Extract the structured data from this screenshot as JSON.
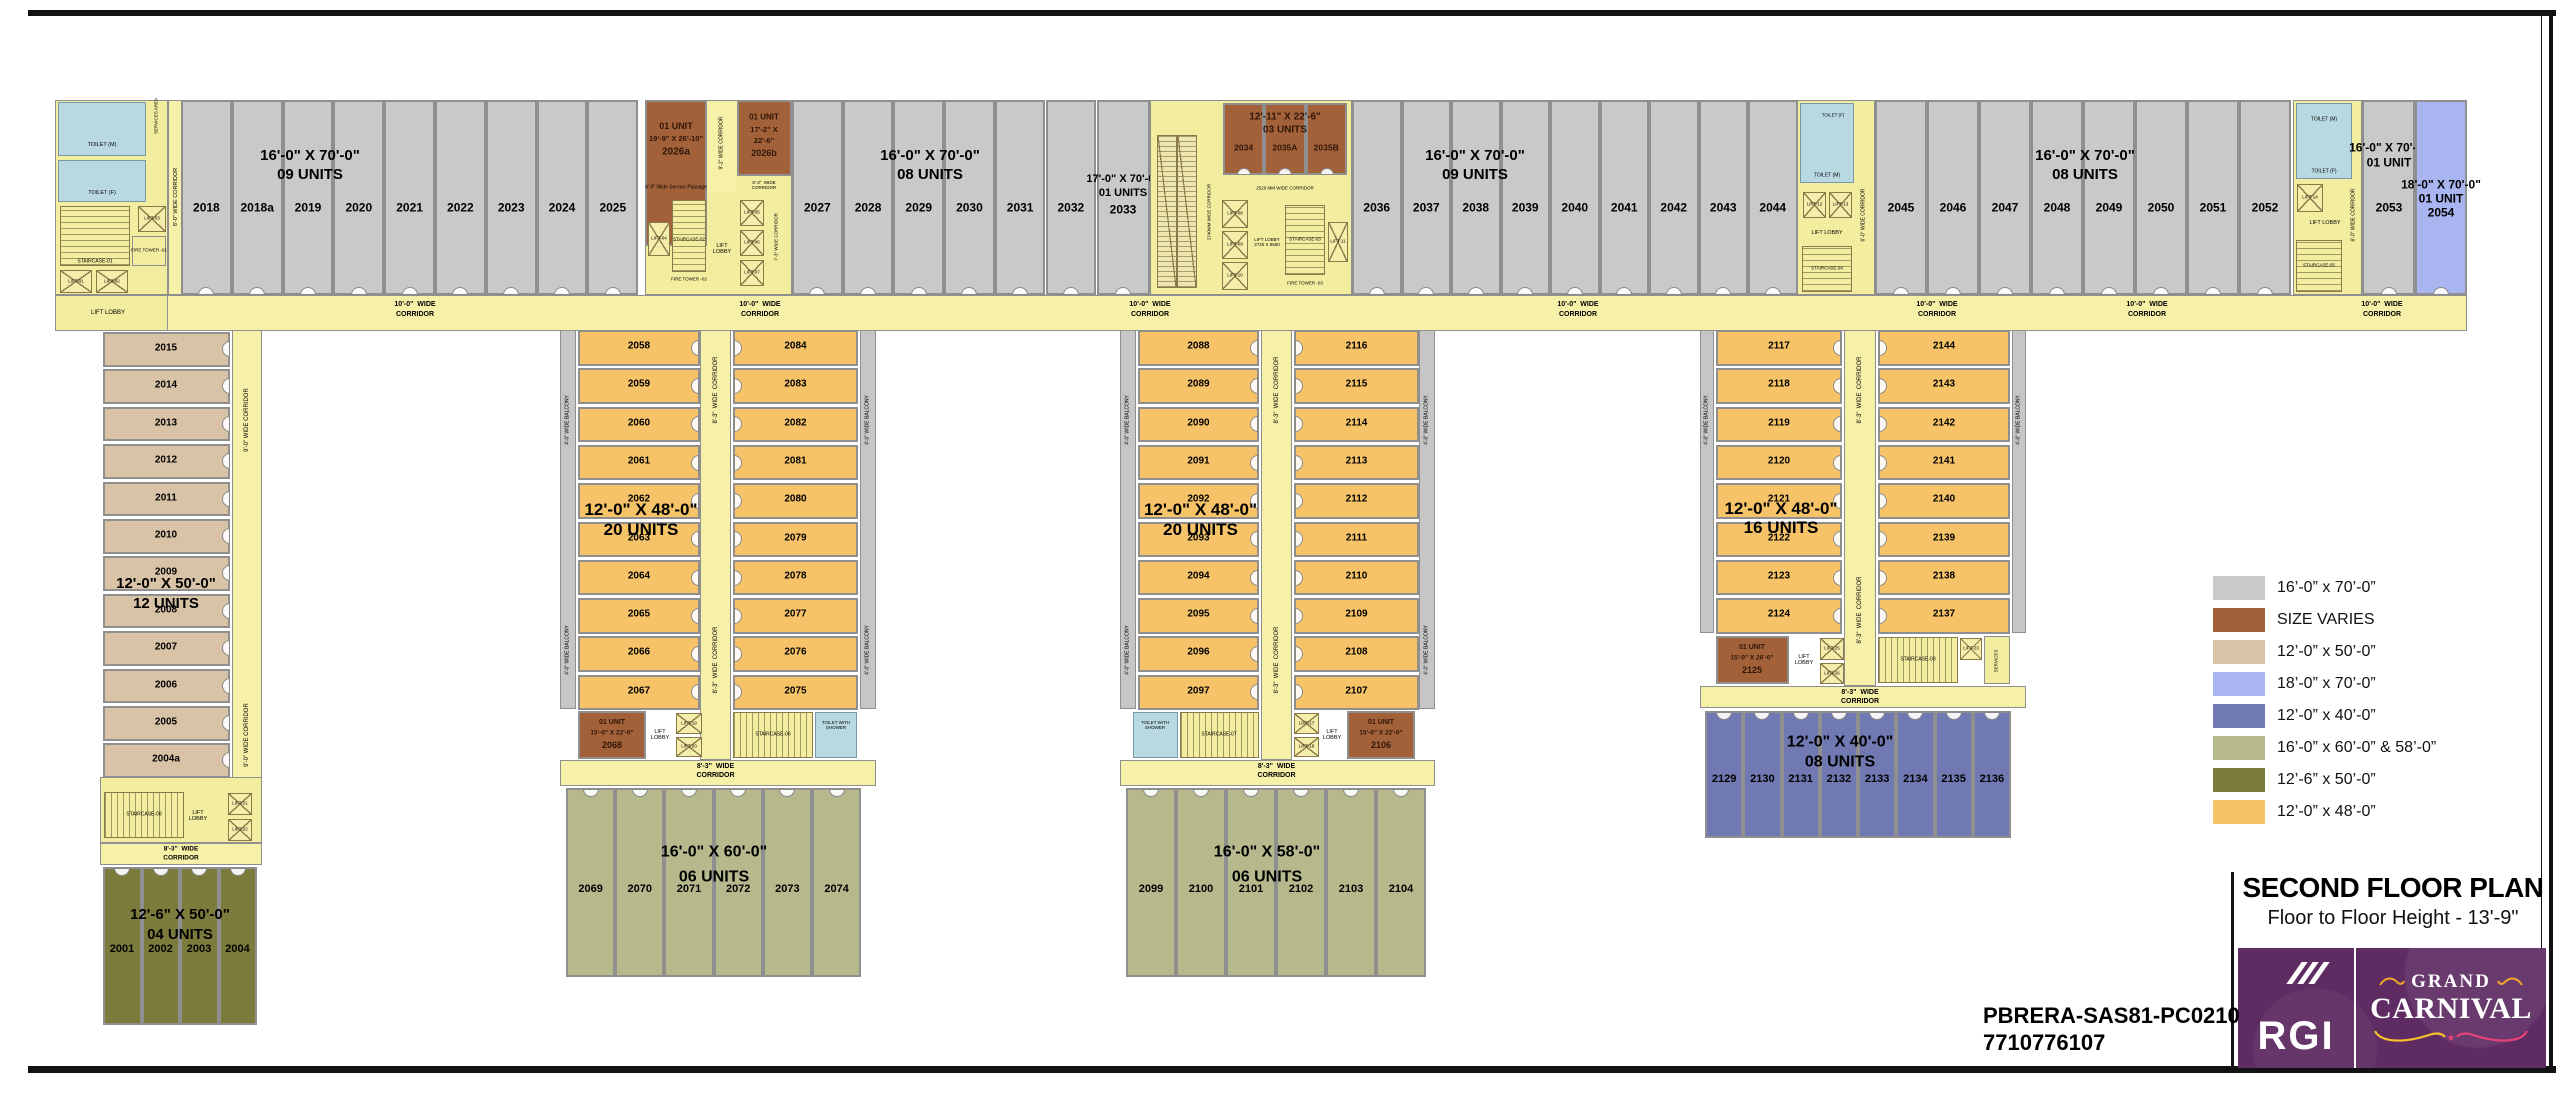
{
  "title_block": {
    "title": "SECOND FLOOR PLAN",
    "subtitle": "Floor to Floor Height - 13'-9\"",
    "rera_line1": "PBRERA-SAS81-PC0210",
    "rera_line2": "7710776107",
    "logo_brand": "RGI",
    "logo_project_line1": "GRAND",
    "logo_project_line2": "CARNIVAL"
  },
  "legend": {
    "items": [
      {
        "color": "#c9c9c9",
        "label": "16’-0” x 70’-0”"
      },
      {
        "color": "#a3613a",
        "label": "SIZE VARIES"
      },
      {
        "color": "#d9c3a7",
        "label": "12’-0” x 50’-0”"
      },
      {
        "color": "#a9b5f0",
        "label": "18’-0” x 70’-0”"
      },
      {
        "color": "#7079b2",
        "label": "12’-0” x 40’-0”"
      },
      {
        "color": "#b5b98c",
        "label": "16’-0” x 60’-0” & 58’-0”"
      },
      {
        "color": "#7b7b3b",
        "label": "12’-6” x 50’-0”"
      },
      {
        "color": "#f6c368",
        "label": "12’-0” x 48’-0”"
      }
    ]
  },
  "corridors": {
    "main_l1": "10'-0\"  WIDE",
    "main_l2": "CORRIDOR",
    "w83": "8'-3\"  WIDE  CORRIDOR",
    "w83_l1": "8'-3\"  WIDE",
    "w83_l2": "CORRIDOR",
    "w90": "9'-0\" WIDE CORRIDOR",
    "w80": "8'-0\" WIDE CORRIDOR",
    "w92": "9'-2\" WIDE CORRIDOR",
    "w73": "7'-3\" WIDE CORRIDOR",
    "w60": "6'-0\" WIDE CORRIDOR",
    "balcony": "4'-0\" WIDE BALCONY",
    "service_passage": "4'-0\" Wide Service Passage",
    "mm2520": "2520 MM WIDE CORRIDOR",
    "mm2740": "2740MM WIDE CORRIDOR"
  },
  "top_strip": {
    "g1": {
      "units": [
        "2018",
        "2018a",
        "2019",
        "2020",
        "2021",
        "2022",
        "2023",
        "2024",
        "2025"
      ],
      "l1": "16'-0\" X 70'-0\"",
      "l2": "09 UNITS"
    },
    "u2026a": {
      "l1": "01 UNIT",
      "l2": "19'-9\" X 26'-10\"",
      "num": "2026a"
    },
    "u2026b": {
      "l1": "01 UNIT",
      "l2": "17'-2\" X",
      "l3": "22'-6\"",
      "num": "2026b"
    },
    "g2": {
      "units": [
        "2027",
        "2028",
        "2029",
        "2030",
        "2031",
        "2032"
      ],
      "l1": "16'-0\" X 70'-0\"",
      "l2": "08 UNITS"
    },
    "u2033": {
      "l1": "17'-0\" X 70'-0\"",
      "l2": "01 UNITS",
      "num": "2033"
    },
    "triplet": {
      "l1": "12'-11\" X 22'-6\"",
      "l2": "03 UNITS",
      "units": [
        "2034",
        "2035A",
        "2035B"
      ]
    },
    "g3": {
      "units": [
        "2036",
        "2037",
        "2038",
        "2039",
        "2040",
        "2041",
        "2042",
        "2043",
        "2044"
      ],
      "l1": "16'-0\" X 70'-0\"",
      "l2": "09 UNITS"
    },
    "g4": {
      "units": [
        "2045",
        "2046",
        "2047",
        "2048",
        "2049",
        "2050",
        "2051",
        "2052"
      ],
      "l1": "16'-0\" X 70'-0\"",
      "l2": "08 UNITS"
    },
    "u2053": {
      "l1": "16'-0\" X 70'-0\"",
      "l2": "01 UNIT",
      "num": "2053"
    },
    "u2054": {
      "l1": "18'-0\" X 70'-0\"",
      "l2": "01 UNIT",
      "num": "2054"
    }
  },
  "cores": {
    "toilet_m": "TOILET (M)",
    "toilet_f": "TOILET (F)",
    "services_area": "SERVICES AREA",
    "services": "SERVICES",
    "lift_lobby": "LIFT LOBBY",
    "lift_lobby_l1": "LIFT",
    "lift_lobby_l2": "LOBBY",
    "lobby_dims": "2740 X 8550",
    "staircase_01": "STAIRCASE-01",
    "fire_tower_01": "FIRE TOWER -01",
    "staircase_02": "STAIRCASE-02",
    "fire_tower_02": "FIRE TOWER -02",
    "staircase_03": "STAIRCASE-03",
    "fire_tower_03": "FIRE TOWER -03",
    "staircase_04": "STAIRCASE-04",
    "staircase_05": "STAIRCASE-05",
    "lift_01": "LIFT-01",
    "lift_02": "LIFT-02",
    "lift_03": "LIFT-03",
    "lift_04": "LIFT-04",
    "lift_05": "LIFT-05",
    "lift_06": "LIFT-06",
    "lift_07": "LIFT-07",
    "lift_08": "LIFT-08",
    "lift_09": "LIFT-09",
    "lift_10": "LIFT-10",
    "lift_11": "LIFT-11",
    "lift_12": "LIFT-12",
    "lift_13": "LIFT-13",
    "lift_14": "LIFT-14"
  },
  "left_wing": {
    "units": [
      "2015",
      "2014",
      "2013",
      "2012",
      "2011",
      "2010",
      "2009",
      "2008",
      "2007",
      "2006",
      "2005",
      "2004a"
    ],
    "label_l1": "12'-0\" X 50'-0\"",
    "label_l2": "12 UNITS",
    "staircase": "STAIRCASE-08",
    "lifts": [
      "LIFT-21",
      "LIFT-22"
    ],
    "bottom_units": [
      "2001",
      "2002",
      "2003",
      "2004"
    ],
    "bottom_label_l1": "12'-6\" X 50'-0\"",
    "bottom_label_l2": "04 UNITS"
  },
  "wing_a": {
    "left_units": [
      "2058",
      "2059",
      "2060",
      "2061",
      "2062",
      "2063",
      "2064",
      "2065",
      "2066",
      "2067"
    ],
    "right_units": [
      "2084",
      "2083",
      "2082",
      "2081",
      "2080",
      "2079",
      "2078",
      "2077",
      "2076",
      "2075"
    ],
    "label_l1": "12'-0\" X 48'-0\"",
    "label_l2": "20 UNITS",
    "special": {
      "l1": "01 UNIT",
      "l2": "15'-0\" X 22'-0\"",
      "num": "2068"
    },
    "staircase": "STAIRCASE-06",
    "lifts": [
      "LIFT-19",
      "LIFT-20"
    ],
    "toilet_l1": "TOILET WITH",
    "toilet_l2": "SHOWER",
    "bottom_units": [
      "2069",
      "2070",
      "2071",
      "2072",
      "2073",
      "2074"
    ],
    "bottom_label_l1": "16'-0\" X 60'-0\"",
    "bottom_label_l2": "06 UNITS"
  },
  "wing_b": {
    "left_units": [
      "2088",
      "2089",
      "2090",
      "2091",
      "2092",
      "2093",
      "2094",
      "2095",
      "2096",
      "2097"
    ],
    "right_units": [
      "2116",
      "2115",
      "2114",
      "2113",
      "2112",
      "2111",
      "2110",
      "2109",
      "2108",
      "2107"
    ],
    "label_l1": "12'-0\" X 48'-0\"",
    "label_l2": "20 UNITS",
    "special": {
      "l1": "01 UNIT",
      "l2": "15'-0\" X 22'-0\"",
      "num": "2106"
    },
    "staircase": "STAIRCASE-07",
    "lifts": [
      "LIFT-17",
      "LIFT-18"
    ],
    "toilet_l1": "TOILET WITH",
    "toilet_l2": "SHOWER",
    "bottom_units": [
      "2099",
      "2100",
      "2101",
      "2102",
      "2103",
      "2104"
    ],
    "bottom_label_l1": "16'-0\" X 58'-0\"",
    "bottom_label_l2": "06 UNITS"
  },
  "wing_c": {
    "left_units": [
      "2117",
      "2118",
      "2119",
      "2120",
      "2121",
      "2122",
      "2123",
      "2124"
    ],
    "right_units": [
      "2144",
      "2143",
      "2142",
      "2141",
      "2140",
      "2139",
      "2138",
      "2137"
    ],
    "label_l1": "12'-0\" X 48'-0\"",
    "label_l2": "16 UNITS",
    "special": {
      "l1": "01 UNIT",
      "l2": "15'-0\" X 26'-0\"",
      "num": "2125"
    },
    "staircase": "STAIRCASE-09",
    "lifts": [
      "LIFT-25",
      "LIFT-26",
      "LIFT-23"
    ],
    "services": "SERVICES",
    "bottom_units": [
      "2129",
      "2130",
      "2131",
      "2132",
      "2133",
      "2134",
      "2135",
      "2136"
    ],
    "bottom_label_l1": "12'-0\" X 40'-0\"",
    "bottom_label_l2": "08 UNITS"
  }
}
